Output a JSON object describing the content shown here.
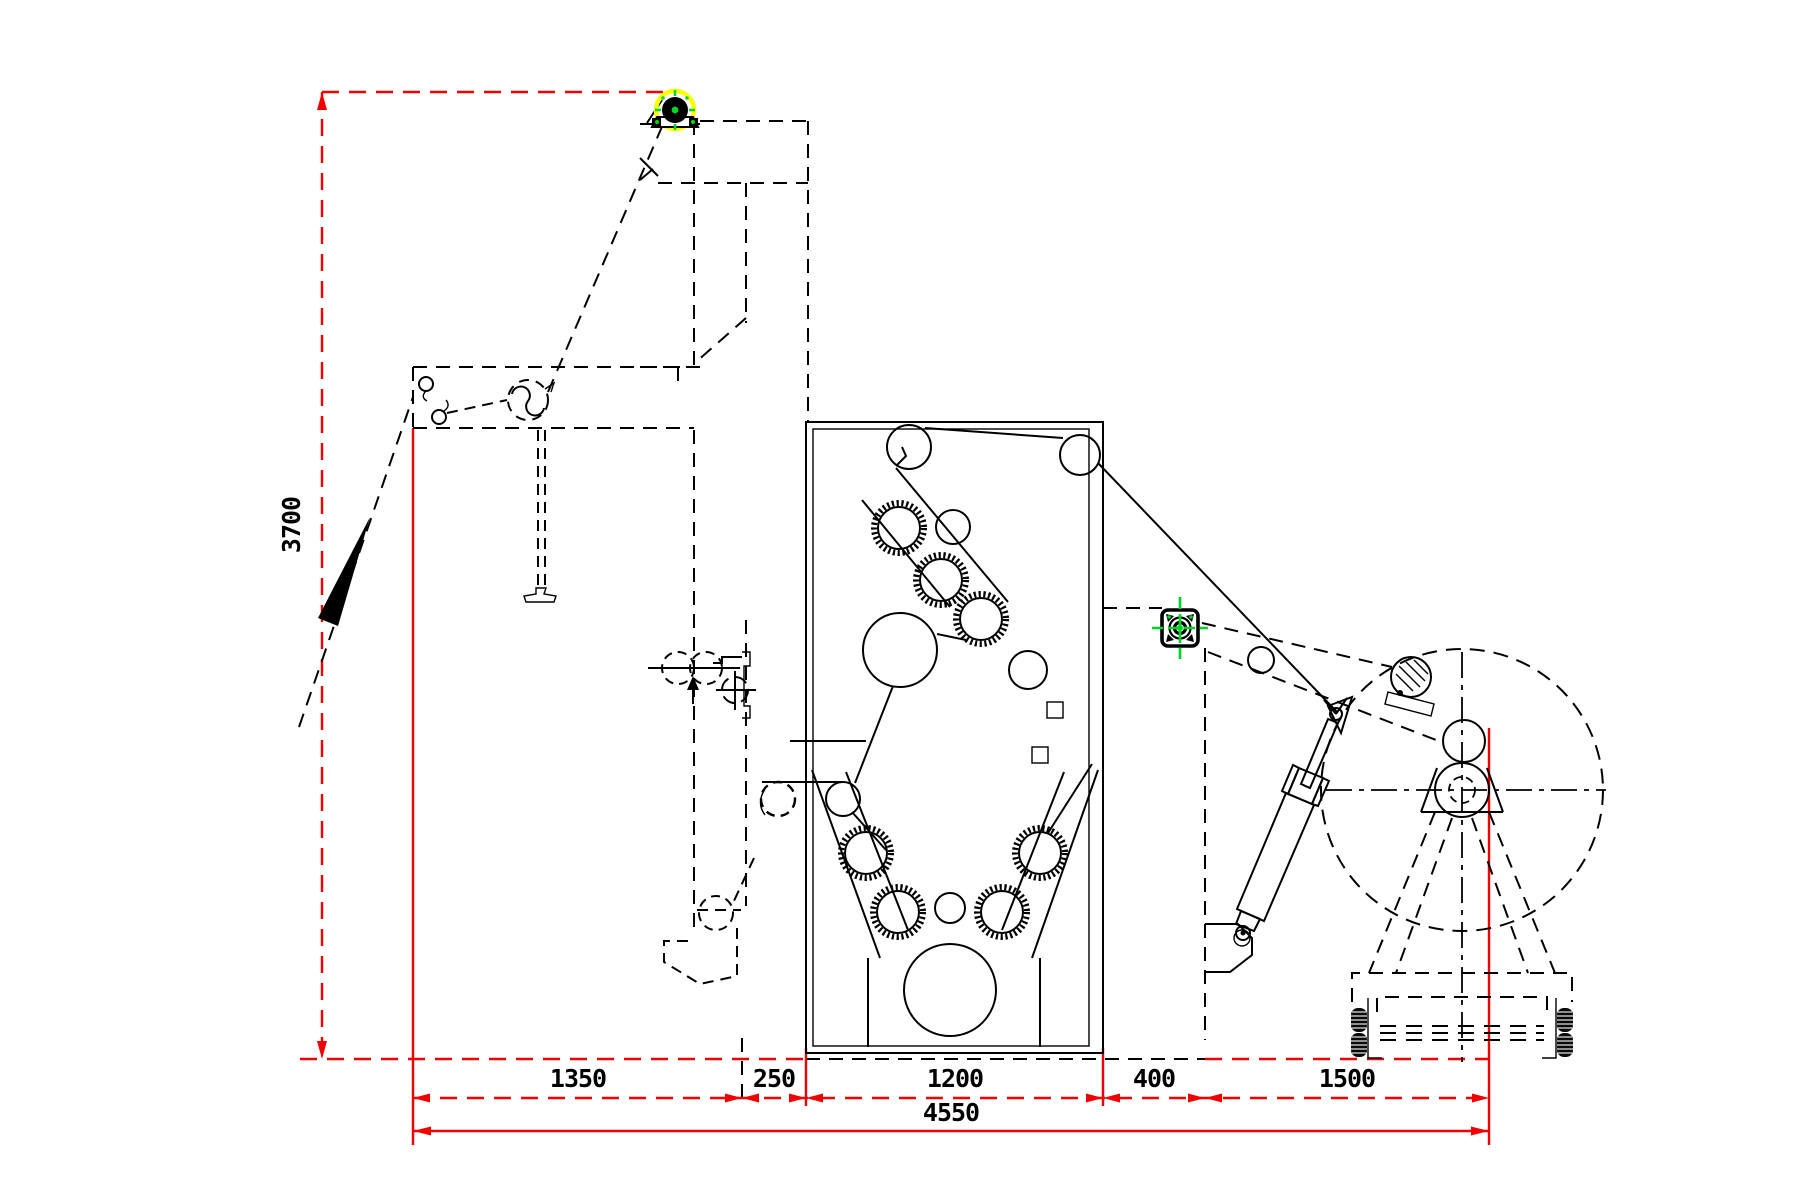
{
  "dimensions": {
    "bottom_row": [
      {
        "label": "1350"
      },
      {
        "label": "250"
      },
      {
        "label": "1200"
      },
      {
        "label": "400"
      },
      {
        "label": "1500"
      }
    ],
    "total": {
      "label": "4550"
    },
    "height": {
      "label": "3700"
    }
  },
  "colors": {
    "background": "#ffffff",
    "outline": "#000000",
    "dimension": "#f00100",
    "highlight_ring": "#ffff00",
    "marker_accent": "#00d629"
  },
  "markers": {
    "top_roller_highlight": "yellow-circle-highlight",
    "pivot_bearing": "green-crosshair-target"
  }
}
